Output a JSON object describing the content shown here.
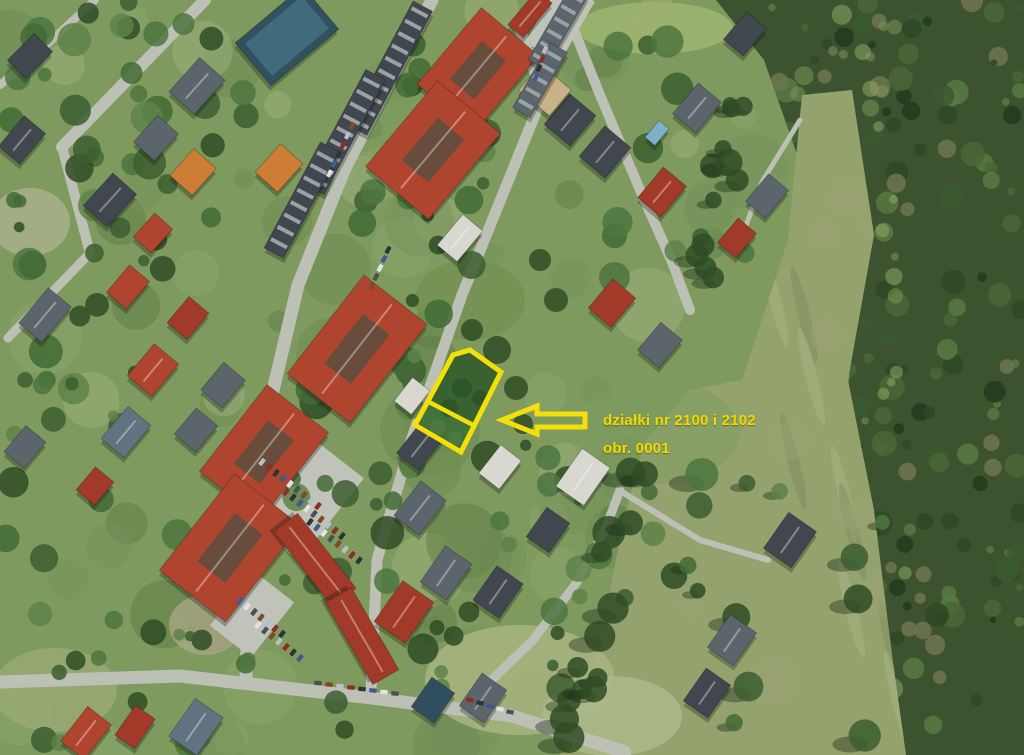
{
  "image": {
    "kind": "aerial-orthophoto-with-annotation",
    "width": 1024,
    "height": 755
  },
  "annotation": {
    "label": {
      "line1": "działki nr 2100 i 2102",
      "line2": "obr. 0001"
    },
    "parcel": {
      "points": "470,350 501,372 461,452 415,425 453,355",
      "upper_points": "453,355 470,350 501,372 473,425 429,402",
      "lower_points": "429,402 473,425 461,452 415,425",
      "divider": {
        "x1": 429,
        "y1": 402,
        "x2": 473,
        "y2": 425
      },
      "stroke_width": 5
    },
    "arrow": {
      "points": "502,420 537,406 537,414 585,414 585,427 537,427 537,434",
      "stroke_width": 5
    }
  },
  "map": {
    "palette": {
      "base": "#7e9a5f",
      "meadow": "#94a36e",
      "forest": "#3d532f",
      "road": "#bcc0b5",
      "parking": "#c0c3b9",
      "red1": "#b0452f",
      "red2": "#a23a2a",
      "orange": "#cd7d35",
      "gray1": "#5c646c",
      "gray2": "#41474e",
      "blue": "#5f7380",
      "white": "#d8d8d0",
      "tan": "#c9b189",
      "teal": "#2f4f5e",
      "pool": "#31525c",
      "poolwater": "#7fb0c8",
      "courtyard": "#5c4f40",
      "shadow": "#141f10",
      "yellow": "#f3e008",
      "labelYellow": "#f2da00",
      "parcelUpper": "#36602e",
      "parcelLower": "#41713a"
    },
    "mottle_colors": [
      "#6b8a52",
      "#8aa56b",
      "#9db07c",
      "#5d7c45",
      "#74915a"
    ],
    "tree_colors": [
      "#3c5e30",
      "#4e7540",
      "#2f4c26",
      "#5d8248",
      "#436b36"
    ],
    "forest_colors": [
      "#243a1c",
      "#2e4824",
      "#4a6636",
      "#3a5a30",
      "#587a42",
      "#6f7450"
    ],
    "forest_light": [
      "#7d9a58",
      "#93ad67"
    ],
    "car_colors": [
      "#b9bfc6",
      "#8e2d24",
      "#2e3338",
      "#3f5a8c",
      "#e2e2e2",
      "#4a5056",
      "#7d4a2a"
    ],
    "forest_poly": [
      [
        716,
        0
      ],
      [
        1024,
        0
      ],
      [
        1024,
        755
      ],
      [
        900,
        755
      ],
      [
        870,
        560
      ],
      [
        844,
        360
      ],
      [
        806,
        180
      ],
      [
        764,
        60
      ]
    ],
    "meadow_poly": [
      [
        802,
        95
      ],
      [
        852,
        90
      ],
      [
        874,
        235
      ],
      [
        848,
        380
      ],
      [
        874,
        510
      ],
      [
        892,
        655
      ],
      [
        906,
        755
      ],
      [
        560,
        755
      ],
      [
        598,
        648
      ],
      [
        624,
        520
      ],
      [
        644,
        442
      ],
      [
        690,
        390
      ],
      [
        742,
        380
      ],
      [
        788,
        240
      ]
    ],
    "patches": [
      {
        "x": 655,
        "y": 28,
        "rx": 78,
        "ry": 26,
        "c": "#9db26f",
        "o": 0.9
      },
      {
        "x": 520,
        "y": 680,
        "rx": 95,
        "ry": 55,
        "c": "#a6b380",
        "o": 0.9
      },
      {
        "x": 612,
        "y": 716,
        "rx": 70,
        "ry": 40,
        "c": "#adb889",
        "o": 0.85
      },
      {
        "x": 55,
        "y": 690,
        "rx": 62,
        "ry": 42,
        "c": "#9aaa76",
        "o": 0.8
      },
      {
        "x": 30,
        "y": 222,
        "rx": 40,
        "ry": 34,
        "c": "#b2b593",
        "o": 0.7
      },
      {
        "x": 205,
        "y": 625,
        "rx": 36,
        "ry": 30,
        "c": "#b0a98a",
        "o": 0.7
      },
      {
        "x": 470,
        "y": 300,
        "rx": 55,
        "ry": 40,
        "c": "#72904f",
        "o": 0.6
      },
      {
        "x": 655,
        "y": 432,
        "rx": 85,
        "ry": 52,
        "c": "#7d9c5e",
        "o": 0.55
      },
      {
        "x": 430,
        "y": 430,
        "rx": 50,
        "ry": 45,
        "c": "#6d8a50",
        "o": 0.55
      }
    ],
    "roads": [
      {
        "pts": [
          [
            205,
            0
          ],
          [
            62,
            147
          ]
        ],
        "w": 12
      },
      {
        "pts": [
          [
            62,
            147
          ],
          [
            90,
            253
          ]
        ],
        "w": 10
      },
      {
        "pts": [
          [
            90,
            253
          ],
          [
            8,
            338
          ]
        ],
        "w": 9
      },
      {
        "pts": [
          [
            95,
            0
          ],
          [
            30,
            60
          ],
          [
            0,
            85
          ]
        ],
        "w": 8
      },
      {
        "pts": [
          [
            432,
            0
          ],
          [
            345,
            168
          ],
          [
            298,
            285
          ],
          [
            266,
            420
          ],
          [
            250,
            555
          ],
          [
            246,
            678
          ]
        ],
        "w": 13
      },
      {
        "pts": [
          [
            520,
            30
          ],
          [
            543,
            95
          ],
          [
            462,
            295
          ],
          [
            412,
            438
          ],
          [
            377,
            560
          ],
          [
            371,
            690
          ]
        ],
        "w": 11
      },
      {
        "pts": [
          [
            562,
            0
          ],
          [
            600,
            95
          ],
          [
            640,
            190
          ],
          [
            672,
            262
          ],
          [
            690,
            310
          ]
        ],
        "w": 10
      },
      {
        "pts": [
          [
            0,
            682
          ],
          [
            180,
            676
          ],
          [
            372,
            698
          ],
          [
            512,
            716
          ],
          [
            625,
            752
          ]
        ],
        "w": 13
      },
      {
        "pts": [
          [
            474,
            697
          ],
          [
            533,
            640
          ],
          [
            575,
            585
          ],
          [
            605,
            530
          ],
          [
            620,
            490
          ]
        ],
        "w": 9
      },
      {
        "pts": [
          [
            622,
            492
          ],
          [
            700,
            540
          ],
          [
            768,
            560
          ]
        ],
        "w": 6
      },
      {
        "pts": [
          [
            800,
            120
          ],
          [
            762,
            182
          ],
          [
            740,
            242
          ]
        ],
        "w": 5
      },
      {
        "pts": [
          [
            266,
            420
          ],
          [
            302,
            455
          ]
        ],
        "w": 8
      }
    ],
    "parkings": [
      {
        "x": 300,
        "y": 495,
        "w": 105,
        "h": 80,
        "r": -52
      },
      {
        "x": 252,
        "y": 614,
        "w": 70,
        "h": 52,
        "r": -52
      },
      {
        "x": 560,
        "y": 22,
        "w": 70,
        "h": 40,
        "r": -60
      }
    ],
    "buildings": [
      {
        "x": 478,
        "y": 70,
        "w": 100,
        "h": 75,
        "r": -50,
        "c": "red1",
        "cy": 1
      },
      {
        "x": 530,
        "y": 14,
        "w": 45,
        "h": 20,
        "r": -50,
        "c": "red2"
      },
      {
        "x": 433,
        "y": 150,
        "w": 112,
        "h": 82,
        "r": -50,
        "c": "red1",
        "cy": 1
      },
      {
        "x": 357,
        "y": 349,
        "w": 125,
        "h": 80,
        "r": -52,
        "c": "red1",
        "cy": 1
      },
      {
        "x": 264,
        "y": 452,
        "w": 110,
        "h": 78,
        "r": -52,
        "c": "red1",
        "cy": 1
      },
      {
        "x": 230,
        "y": 548,
        "w": 122,
        "h": 84,
        "r": -52,
        "c": "red1",
        "cy": 1
      },
      {
        "x": 315,
        "y": 560,
        "w": 95,
        "h": 30,
        "r": 52,
        "c": "red2"
      },
      {
        "x": 362,
        "y": 636,
        "w": 95,
        "h": 30,
        "r": 60,
        "c": "red2"
      },
      {
        "x": 404,
        "y": 612,
        "w": 50,
        "h": 38,
        "r": -55,
        "c": "red2"
      },
      {
        "x": 86,
        "y": 733,
        "w": 44,
        "h": 30,
        "r": -52,
        "c": "red1"
      },
      {
        "x": 128,
        "y": 287,
        "w": 36,
        "h": 26,
        "r": -50,
        "c": "red1"
      },
      {
        "x": 188,
        "y": 318,
        "w": 34,
        "h": 26,
        "r": -50,
        "c": "red2"
      },
      {
        "x": 153,
        "y": 370,
        "w": 42,
        "h": 32,
        "r": -50,
        "c": "red1"
      },
      {
        "x": 95,
        "y": 486,
        "w": 30,
        "h": 24,
        "r": -50,
        "c": "red2"
      },
      {
        "x": 153,
        "y": 233,
        "w": 32,
        "h": 24,
        "r": -48,
        "c": "red1"
      },
      {
        "x": 662,
        "y": 192,
        "w": 40,
        "h": 30,
        "r": -50,
        "c": "red2"
      },
      {
        "x": 612,
        "y": 303,
        "w": 38,
        "h": 30,
        "r": -50,
        "c": "red2"
      },
      {
        "x": 135,
        "y": 727,
        "w": 36,
        "h": 24,
        "r": -55,
        "c": "red2"
      },
      {
        "x": 737,
        "y": 238,
        "w": 32,
        "h": 24,
        "r": -50,
        "c": "red2"
      },
      {
        "x": 193,
        "y": 172,
        "w": 36,
        "h": 30,
        "r": -48,
        "c": "orange"
      },
      {
        "x": 279,
        "y": 168,
        "w": 38,
        "h": 30,
        "r": -48,
        "c": "orange"
      },
      {
        "x": 22,
        "y": 140,
        "w": 40,
        "h": 28,
        "r": -50,
        "c": "gray2"
      },
      {
        "x": 30,
        "y": 56,
        "w": 38,
        "h": 26,
        "r": -45,
        "c": "gray2"
      },
      {
        "x": 197,
        "y": 86,
        "w": 46,
        "h": 34,
        "r": -48,
        "c": "gray1"
      },
      {
        "x": 156,
        "y": 138,
        "w": 36,
        "h": 28,
        "r": -48,
        "c": "gray1"
      },
      {
        "x": 110,
        "y": 200,
        "w": 44,
        "h": 32,
        "r": -48,
        "c": "gray2"
      },
      {
        "x": 45,
        "y": 315,
        "w": 46,
        "h": 30,
        "r": -50,
        "c": "gray1"
      },
      {
        "x": 223,
        "y": 385,
        "w": 36,
        "h": 28,
        "r": -50,
        "c": "gray1"
      },
      {
        "x": 126,
        "y": 432,
        "w": 42,
        "h": 30,
        "r": -50,
        "c": "blue"
      },
      {
        "x": 196,
        "y": 430,
        "w": 34,
        "h": 28,
        "r": -50,
        "c": "gray1"
      },
      {
        "x": 25,
        "y": 447,
        "w": 34,
        "h": 26,
        "r": -50,
        "c": "gray1"
      },
      {
        "x": 196,
        "y": 727,
        "w": 46,
        "h": 34,
        "r": -55,
        "c": "blue"
      },
      {
        "x": 570,
        "y": 120,
        "w": 40,
        "h": 34,
        "r": -50,
        "c": "gray2"
      },
      {
        "x": 605,
        "y": 152,
        "w": 40,
        "h": 34,
        "r": -50,
        "c": "gray2"
      },
      {
        "x": 697,
        "y": 108,
        "w": 40,
        "h": 30,
        "r": -50,
        "c": "gray1"
      },
      {
        "x": 745,
        "y": 34,
        "w": 36,
        "h": 26,
        "r": -50,
        "c": "gray2"
      },
      {
        "x": 767,
        "y": 196,
        "w": 36,
        "h": 26,
        "r": -50,
        "c": "gray1"
      },
      {
        "x": 583,
        "y": 477,
        "w": 46,
        "h": 34,
        "r": -55,
        "c": "white"
      },
      {
        "x": 548,
        "y": 530,
        "w": 36,
        "h": 28,
        "r": -55,
        "c": "gray2"
      },
      {
        "x": 790,
        "y": 540,
        "w": 44,
        "h": 34,
        "r": -55,
        "c": "gray2"
      },
      {
        "x": 732,
        "y": 640,
        "w": 40,
        "h": 32,
        "r": -55,
        "c": "gray1"
      },
      {
        "x": 707,
        "y": 693,
        "w": 40,
        "h": 30,
        "r": -55,
        "c": "gray2"
      },
      {
        "x": 483,
        "y": 698,
        "w": 40,
        "h": 30,
        "r": -55,
        "c": "gray1"
      },
      {
        "x": 433,
        "y": 700,
        "w": 36,
        "h": 28,
        "r": -55,
        "c": "teal"
      },
      {
        "x": 460,
        "y": 238,
        "w": 40,
        "h": 26,
        "r": -50,
        "c": "white"
      },
      {
        "x": 545,
        "y": 90,
        "w": 34,
        "h": 40,
        "r": -50,
        "c": "tan"
      },
      {
        "x": 660,
        "y": 345,
        "w": 36,
        "h": 28,
        "r": -50,
        "c": "gray1"
      },
      {
        "x": 420,
        "y": 508,
        "w": 44,
        "h": 32,
        "r": -52,
        "c": "gray1"
      },
      {
        "x": 420,
        "y": 446,
        "w": 40,
        "h": 28,
        "r": -52,
        "c": "gray2"
      },
      {
        "x": 412,
        "y": 396,
        "w": 30,
        "h": 22,
        "r": -52,
        "c": "white"
      },
      {
        "x": 446,
        "y": 573,
        "w": 44,
        "h": 32,
        "r": -55,
        "c": "gray1"
      },
      {
        "x": 498,
        "y": 592,
        "w": 42,
        "h": 32,
        "r": -55,
        "c": "gray2"
      },
      {
        "x": 500,
        "y": 467,
        "w": 36,
        "h": 26,
        "r": -52,
        "c": "white"
      },
      {
        "x": 558,
        "y": 28,
        "w": 85,
        "h": 20,
        "r": -60,
        "c": "gray1",
        "st": 1
      },
      {
        "x": 540,
        "y": 80,
        "w": 75,
        "h": 20,
        "r": -60,
        "c": "gray1",
        "st": 1
      },
      {
        "x": 390,
        "y": 68,
        "w": 140,
        "h": 22,
        "r": -62,
        "c": "gray2",
        "st": 1
      },
      {
        "x": 345,
        "y": 132,
        "w": 130,
        "h": 22,
        "r": -62,
        "c": "gray2",
        "st": 1
      },
      {
        "x": 302,
        "y": 200,
        "w": 120,
        "h": 22,
        "r": -62,
        "c": "gray2",
        "st": 1
      },
      {
        "x": 287,
        "y": 36,
        "w": 88,
        "h": 56,
        "r": -40,
        "c": "pool"
      },
      {
        "x": 657,
        "y": 133,
        "w": 22,
        "h": 13,
        "r": -50,
        "c": "poolwater"
      }
    ],
    "car_rows": [
      {
        "x": 262,
        "y": 462,
        "n": 9,
        "dx": 7,
        "dy": 5.5,
        "r": -52
      },
      {
        "x": 286,
        "y": 492,
        "n": 9,
        "dx": 7,
        "dy": 5.5,
        "r": -52
      },
      {
        "x": 310,
        "y": 522,
        "n": 8,
        "dx": 7,
        "dy": 5.5,
        "r": -52
      },
      {
        "x": 240,
        "y": 601,
        "n": 7,
        "dx": 7,
        "dy": 5.5,
        "r": -52
      },
      {
        "x": 258,
        "y": 625,
        "n": 7,
        "dx": 7,
        "dy": 5.5,
        "r": -52
      },
      {
        "x": 318,
        "y": 683,
        "n": 8,
        "dx": 11,
        "dy": 1.5,
        "r": 5
      },
      {
        "x": 352,
        "y": 126,
        "n": 6,
        "dx": -4.5,
        "dy": 9.5,
        "r": -62
      },
      {
        "x": 545,
        "y": 50,
        "n": 4,
        "dx": -3,
        "dy": 9,
        "r": -65
      },
      {
        "x": 470,
        "y": 700,
        "n": 5,
        "dx": 10,
        "dy": 3,
        "r": 12
      },
      {
        "x": 388,
        "y": 250,
        "n": 5,
        "dx": -4,
        "dy": 9,
        "r": -62
      }
    ],
    "tree_scatter": [
      {
        "seed": 11,
        "count": 40,
        "box": [
          0,
          0,
          250,
          270
        ]
      },
      {
        "seed": 12,
        "count": 22,
        "box": [
          0,
          260,
          190,
          300
        ]
      },
      {
        "seed": 13,
        "count": 55,
        "band": [
          470,
          40,
          330,
          530,
          65
        ]
      },
      {
        "seed": 14,
        "count": 26,
        "box": [
          40,
          520,
          380,
          235
        ]
      },
      {
        "seed": 15,
        "count": 16,
        "box": [
          420,
          440,
          220,
          260
        ]
      },
      {
        "seed": 16,
        "count": 14,
        "box": [
          590,
          40,
          170,
          260
        ]
      },
      {
        "seed": 17,
        "count": 12,
        "box": [
          540,
          420,
          200,
          280
        ]
      },
      {
        "seed": 18,
        "count": 14,
        "line": [
          [
            652,
            395
          ],
          [
            592,
            650
          ],
          [
            566,
            750
          ]
        ],
        "spread": 16,
        "rmin": 9,
        "rmax": 16,
        "dark": true,
        "shadow": true
      },
      {
        "seed": 19,
        "count": 10,
        "line": [
          [
            700,
            290
          ],
          [
            745,
            95
          ]
        ],
        "spread": 14,
        "rmin": 8,
        "rmax": 14,
        "dark": true,
        "shadow": true
      },
      {
        "seed": 20,
        "count": 14,
        "box": [
          640,
          420,
          250,
          330
        ],
        "shadow": true
      }
    ],
    "post_trees": [
      {
        "x": 497,
        "y": 350,
        "r": 14
      },
      {
        "x": 516,
        "y": 388,
        "r": 12
      },
      {
        "x": 472,
        "y": 330,
        "r": 11
      },
      {
        "x": 523,
        "y": 424,
        "r": 10
      },
      {
        "x": 556,
        "y": 300,
        "r": 12
      },
      {
        "x": 540,
        "y": 260,
        "r": 11
      }
    ]
  }
}
